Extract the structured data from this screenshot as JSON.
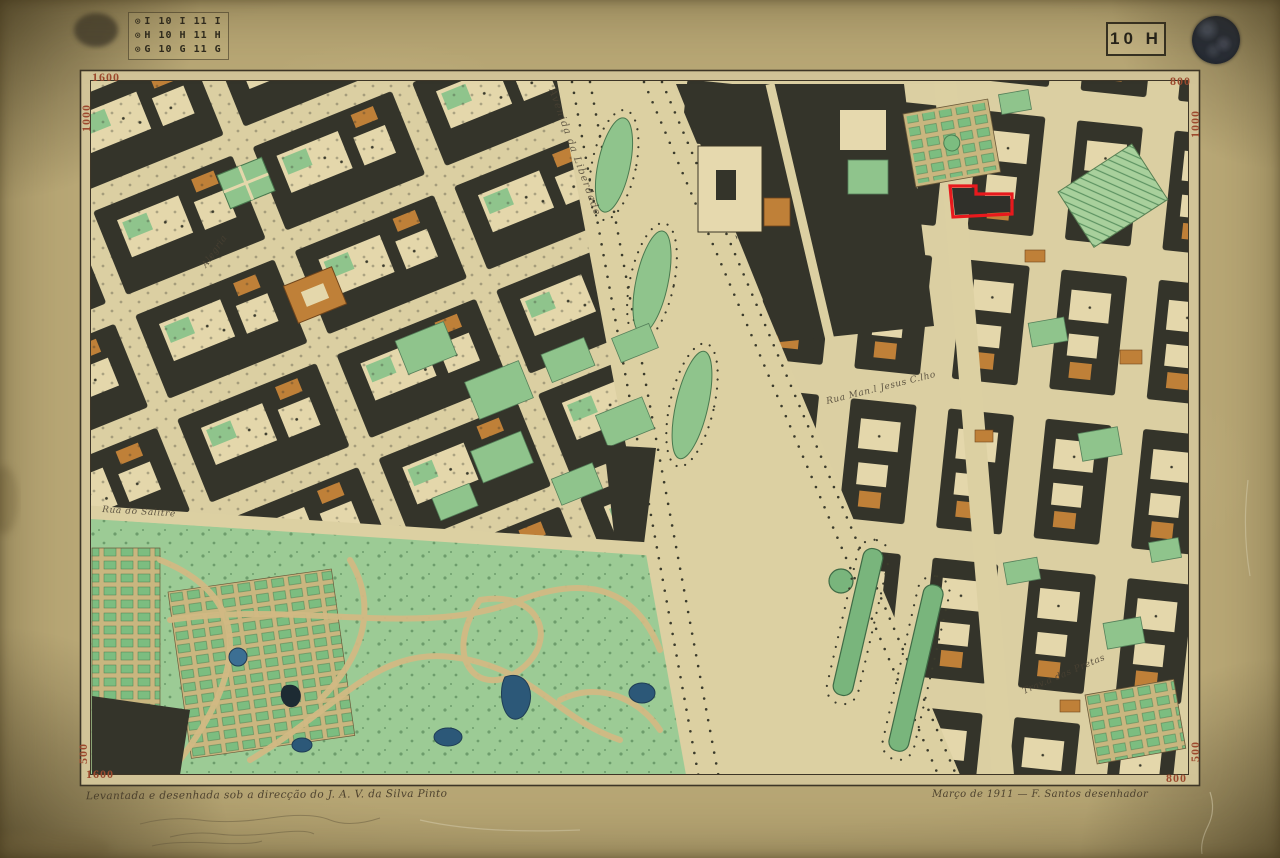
{
  "sheet": {
    "index_stamp": {
      "mark": "⊙",
      "rows": [
        "I 10 I 11 I",
        "H 10 H 11 H",
        "G 10 G 11 G"
      ]
    },
    "sheet_label": "10 H",
    "seal": "circular-ink-seal",
    "corner_coordinates": {
      "top_left_horizontal": "1600",
      "top_left_vertical": "1000",
      "top_right_horizontal": "800",
      "top_right_vertical": "1000",
      "bottom_left_horizontal": "1600",
      "bottom_left_vertical": "500",
      "bottom_right_horizontal": "800",
      "bottom_right_vertical": "500"
    },
    "caption_left": "Levantada e desenhada sob a direcção do J. A. V. da Silva Pinto",
    "caption_right": "Março de 1911 — F. Santos desenhador"
  },
  "map": {
    "labels": [
      {
        "text": "Avenida da Liberdade"
      },
      {
        "text": "Rua do Salitre"
      },
      {
        "text": "Rua Man.l Jesus C.lho"
      },
      {
        "text": "Trav.a das Pretas"
      },
      {
        "text": "Alegria"
      }
    ],
    "highlighted_parcel": {
      "outline_color": "#e8191d"
    }
  },
  "colors": {
    "board_paper": "#b9a876",
    "map_paper": "#dbcfa2",
    "block_dark": "#34342a",
    "garden_green": "#9ccb95",
    "parterre_green": "#7cbd80",
    "pond_blue": "#2c5878",
    "building_orange": "#bf8038",
    "corner_number_red": "#9c4a2e",
    "highlight_red": "#e8191d",
    "seal_ink": "#1d222b"
  }
}
